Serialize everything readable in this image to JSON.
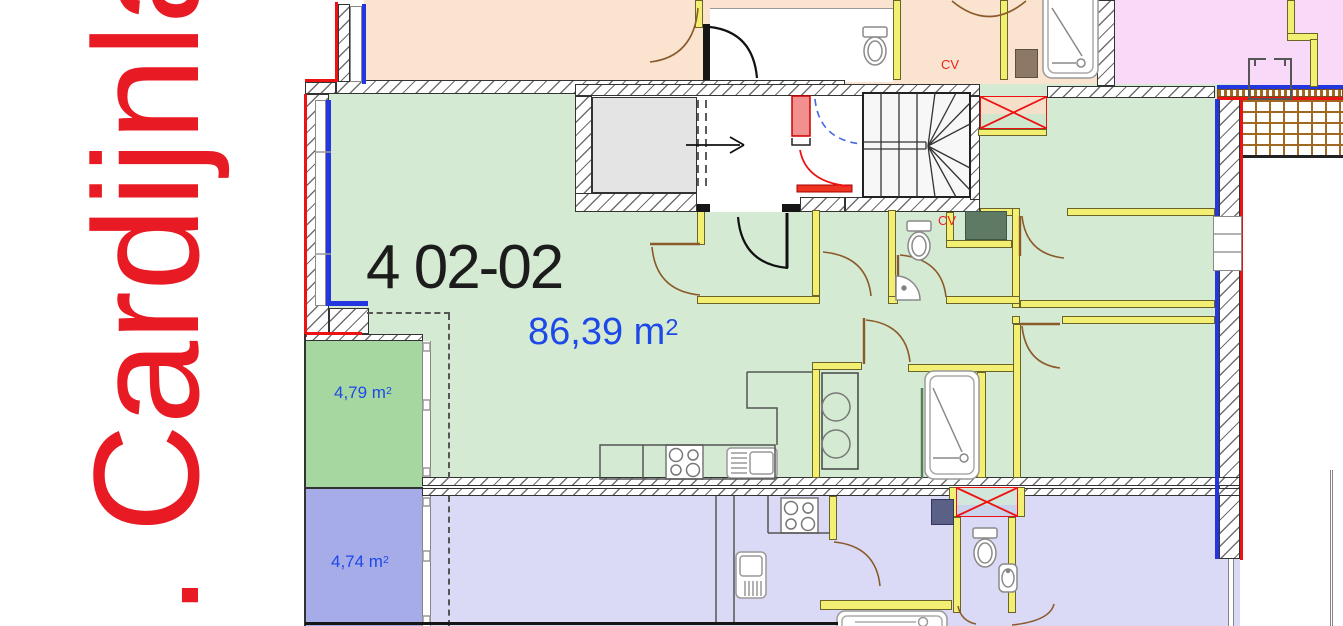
{
  "street_label": ". Cardijnlaan",
  "unit": {
    "id": "4 02-02",
    "area": "86,39 m",
    "area_sup": "2"
  },
  "balconies": [
    {
      "area": "4,79 m",
      "sup": "2"
    },
    {
      "area": "4,74 m",
      "sup": "2"
    }
  ],
  "cv": {
    "top": "CV",
    "mid": "CV"
  },
  "colors": {
    "street_text": "#e81b24",
    "unit_text": "#1c1c1c",
    "area_text": "#1d49e8",
    "apartment_green": "#d5ead2",
    "apartment_peach": "#fae3cf",
    "apartment_pink": "#f8daf8",
    "apartment_purple": "#dadaf6",
    "balcony_green": "#a7d7a1",
    "balcony_blue": "#a6ace7",
    "interior_wall_yellow": "#f3ef72",
    "window_blue": "#2336e0",
    "exterior_red": "#ee1313",
    "door_brown": "#8a5a2a",
    "elevator_gray": "#e4e4e4"
  }
}
